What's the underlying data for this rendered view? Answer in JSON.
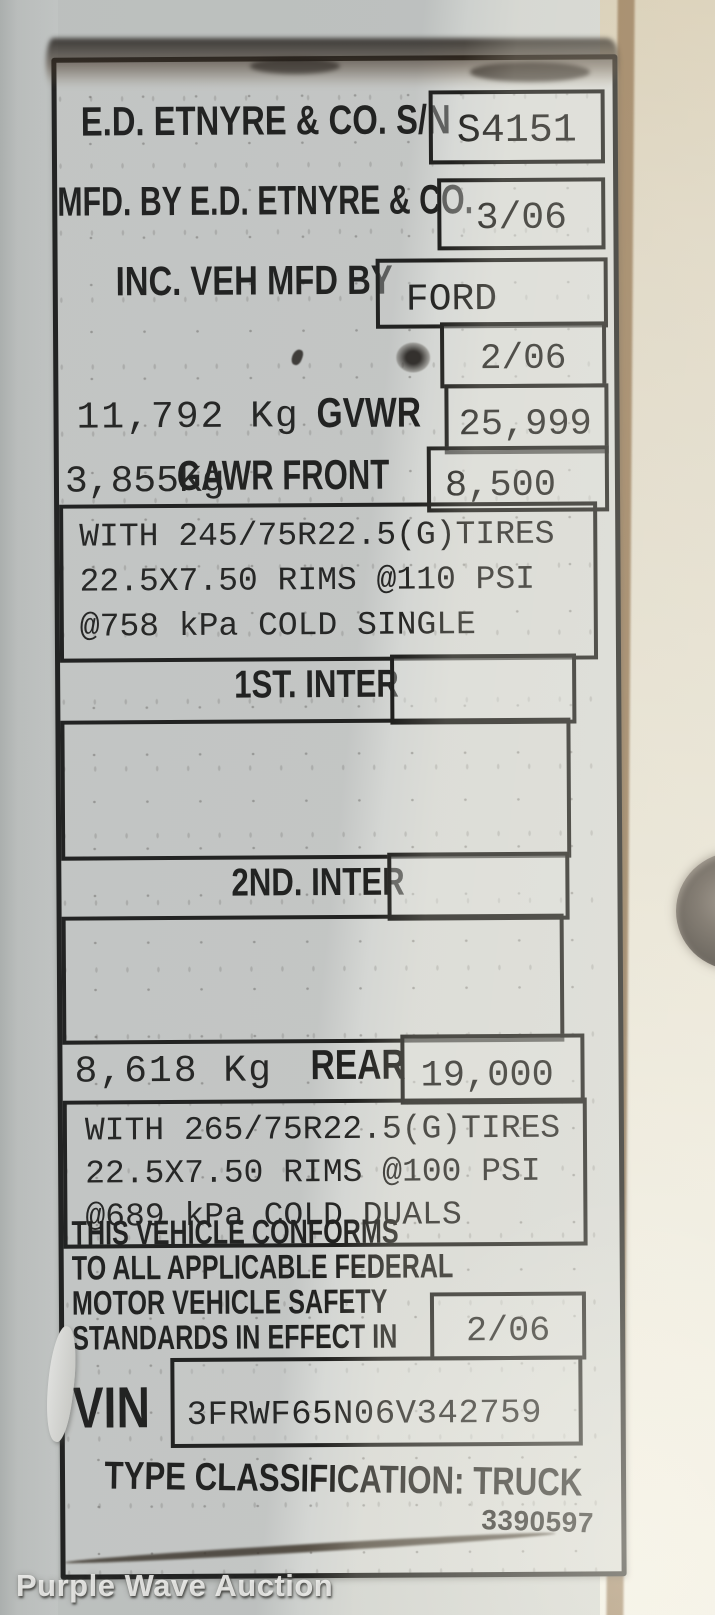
{
  "colors": {
    "ink": "#1d1d1b",
    "paper": "#d4d6d3",
    "rust": "#8a6a45",
    "sunlight": "#fffbed"
  },
  "watermark": {
    "text": "Purple Wave Auction"
  },
  "plate": {
    "serial": {
      "label": "E.D. ETNYRE & CO. S/N",
      "value": "S4151"
    },
    "mfd_by": {
      "label": "MFD. BY E.D. ETNYRE & CO.",
      "value": "3/06"
    },
    "inc_veh": {
      "label": "INC. VEH MFD BY",
      "value": "FORD"
    },
    "inc_veh_date": {
      "value": "2/06"
    },
    "gvwr": {
      "metric": "11,792 Kg",
      "label": "GVWR",
      "value": "25,999"
    },
    "gawr_front": {
      "metric": "3,855Kg",
      "label": "GAWR FRONT",
      "value": "8,500"
    },
    "front_tires": {
      "lines": [
        "WITH 245/75R22.5(G)TIRES",
        "22.5X7.50 RIMS @110 PSI",
        "@758 kPa COLD SINGLE"
      ]
    },
    "first_inter": {
      "label": "1ST. INTER",
      "value": ""
    },
    "second_inter": {
      "label": "2ND. INTER",
      "value": ""
    },
    "gawr_rear": {
      "metric": "8,618 Kg",
      "label": "REAR",
      "value": "19,000"
    },
    "rear_tires": {
      "lines": [
        "WITH 265/75R22.5(G)TIRES",
        "22.5X7.50 RIMS @100 PSI",
        "@689 kPa COLD DUALS"
      ]
    },
    "conformity": {
      "lines": [
        "THIS VEHICLE CONFORMS",
        "TO ALL APPLICABLE FEDERAL",
        "MOTOR VEHICLE SAFETY",
        "STANDARDS IN EFFECT IN"
      ],
      "value": "2/06"
    },
    "vin": {
      "label": "VIN",
      "value": "3FRWF65N06V342759"
    },
    "type_classification": "TYPE CLASSIFICATION: TRUCK",
    "form_number": "3390597"
  }
}
